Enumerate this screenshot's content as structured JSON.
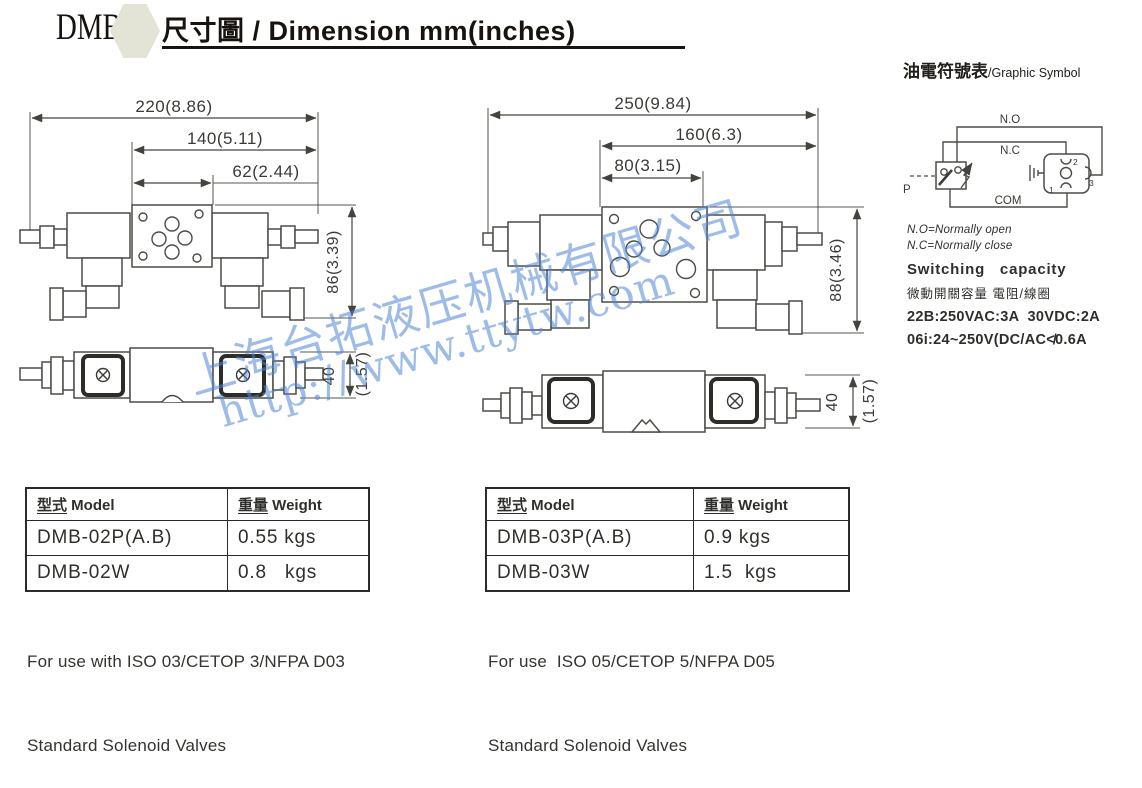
{
  "header": {
    "logo": "DMB",
    "title_zh": "尺寸圖",
    "title_sep": " / ",
    "title_en": "Dimension mm(inches)"
  },
  "drawings": {
    "left_front": {
      "total": "220(8.86)",
      "mid": "140(5.11)",
      "inner": "62(2.44)",
      "height": "86(3.39)"
    },
    "left_bottom": {
      "height_mm": "40",
      "height_in": "(1.57)"
    },
    "right_front": {
      "total": "250(9.84)",
      "mid": "160(6.3)",
      "inner": "80(3.15)",
      "height": "88(3.46)"
    },
    "right_bottom": {
      "height_mm": "40",
      "height_in": "(1.57)"
    }
  },
  "symbol": {
    "title_zh": "油電符號表",
    "title_en": "/Graphic Symbol",
    "labels": {
      "no": "N.O",
      "nc": "N.C",
      "com": "COM",
      "p": "P",
      "pin1": "1",
      "pin2": "2",
      "pin3": "3"
    },
    "notes": [
      "N.O=Normally open",
      "N.C=Normally close"
    ],
    "switching_title": "Switching   capacity",
    "switching_zh": "微動開關容量 電阻/線圈",
    "spec1": "22B:250VAC:3A  30VDC:2A",
    "spec2": "06i:24~250V(DC/AC≮0.6A"
  },
  "tables": {
    "left": {
      "header": [
        {
          "zh": "型式",
          "en": " Model"
        },
        {
          "zh": "重量",
          "en": " Weight"
        }
      ],
      "rows": [
        [
          "DMB-02P(A.B)",
          "0.55 kgs"
        ],
        [
          "DMB-02W",
          "0.8   kgs"
        ]
      ],
      "footer": [
        "For use with ISO 03/CETOP 3/NFPA D03",
        "Standard Solenoid Valves"
      ]
    },
    "right": {
      "header": [
        {
          "zh": "型式",
          "en": " Model"
        },
        {
          "zh": "重量",
          "en": " Weight"
        }
      ],
      "rows": [
        [
          "DMB-03P(A.B)",
          "0.9 kgs"
        ],
        [
          "DMB-03W",
          "1.5  kgs"
        ]
      ],
      "footer": [
        "For use  ISO 05/CETOP 5/NFPA D05",
        "Standard Solenoid Valves"
      ]
    }
  },
  "watermark": {
    "line1": "上海台拓液压机械有限公司",
    "line2": "http://www.ttytw.com",
    "color": "#4f86d8"
  },
  "colors": {
    "line": "#4c4c47",
    "hex_badge": "#e4e4d6",
    "text": "#17130e"
  }
}
